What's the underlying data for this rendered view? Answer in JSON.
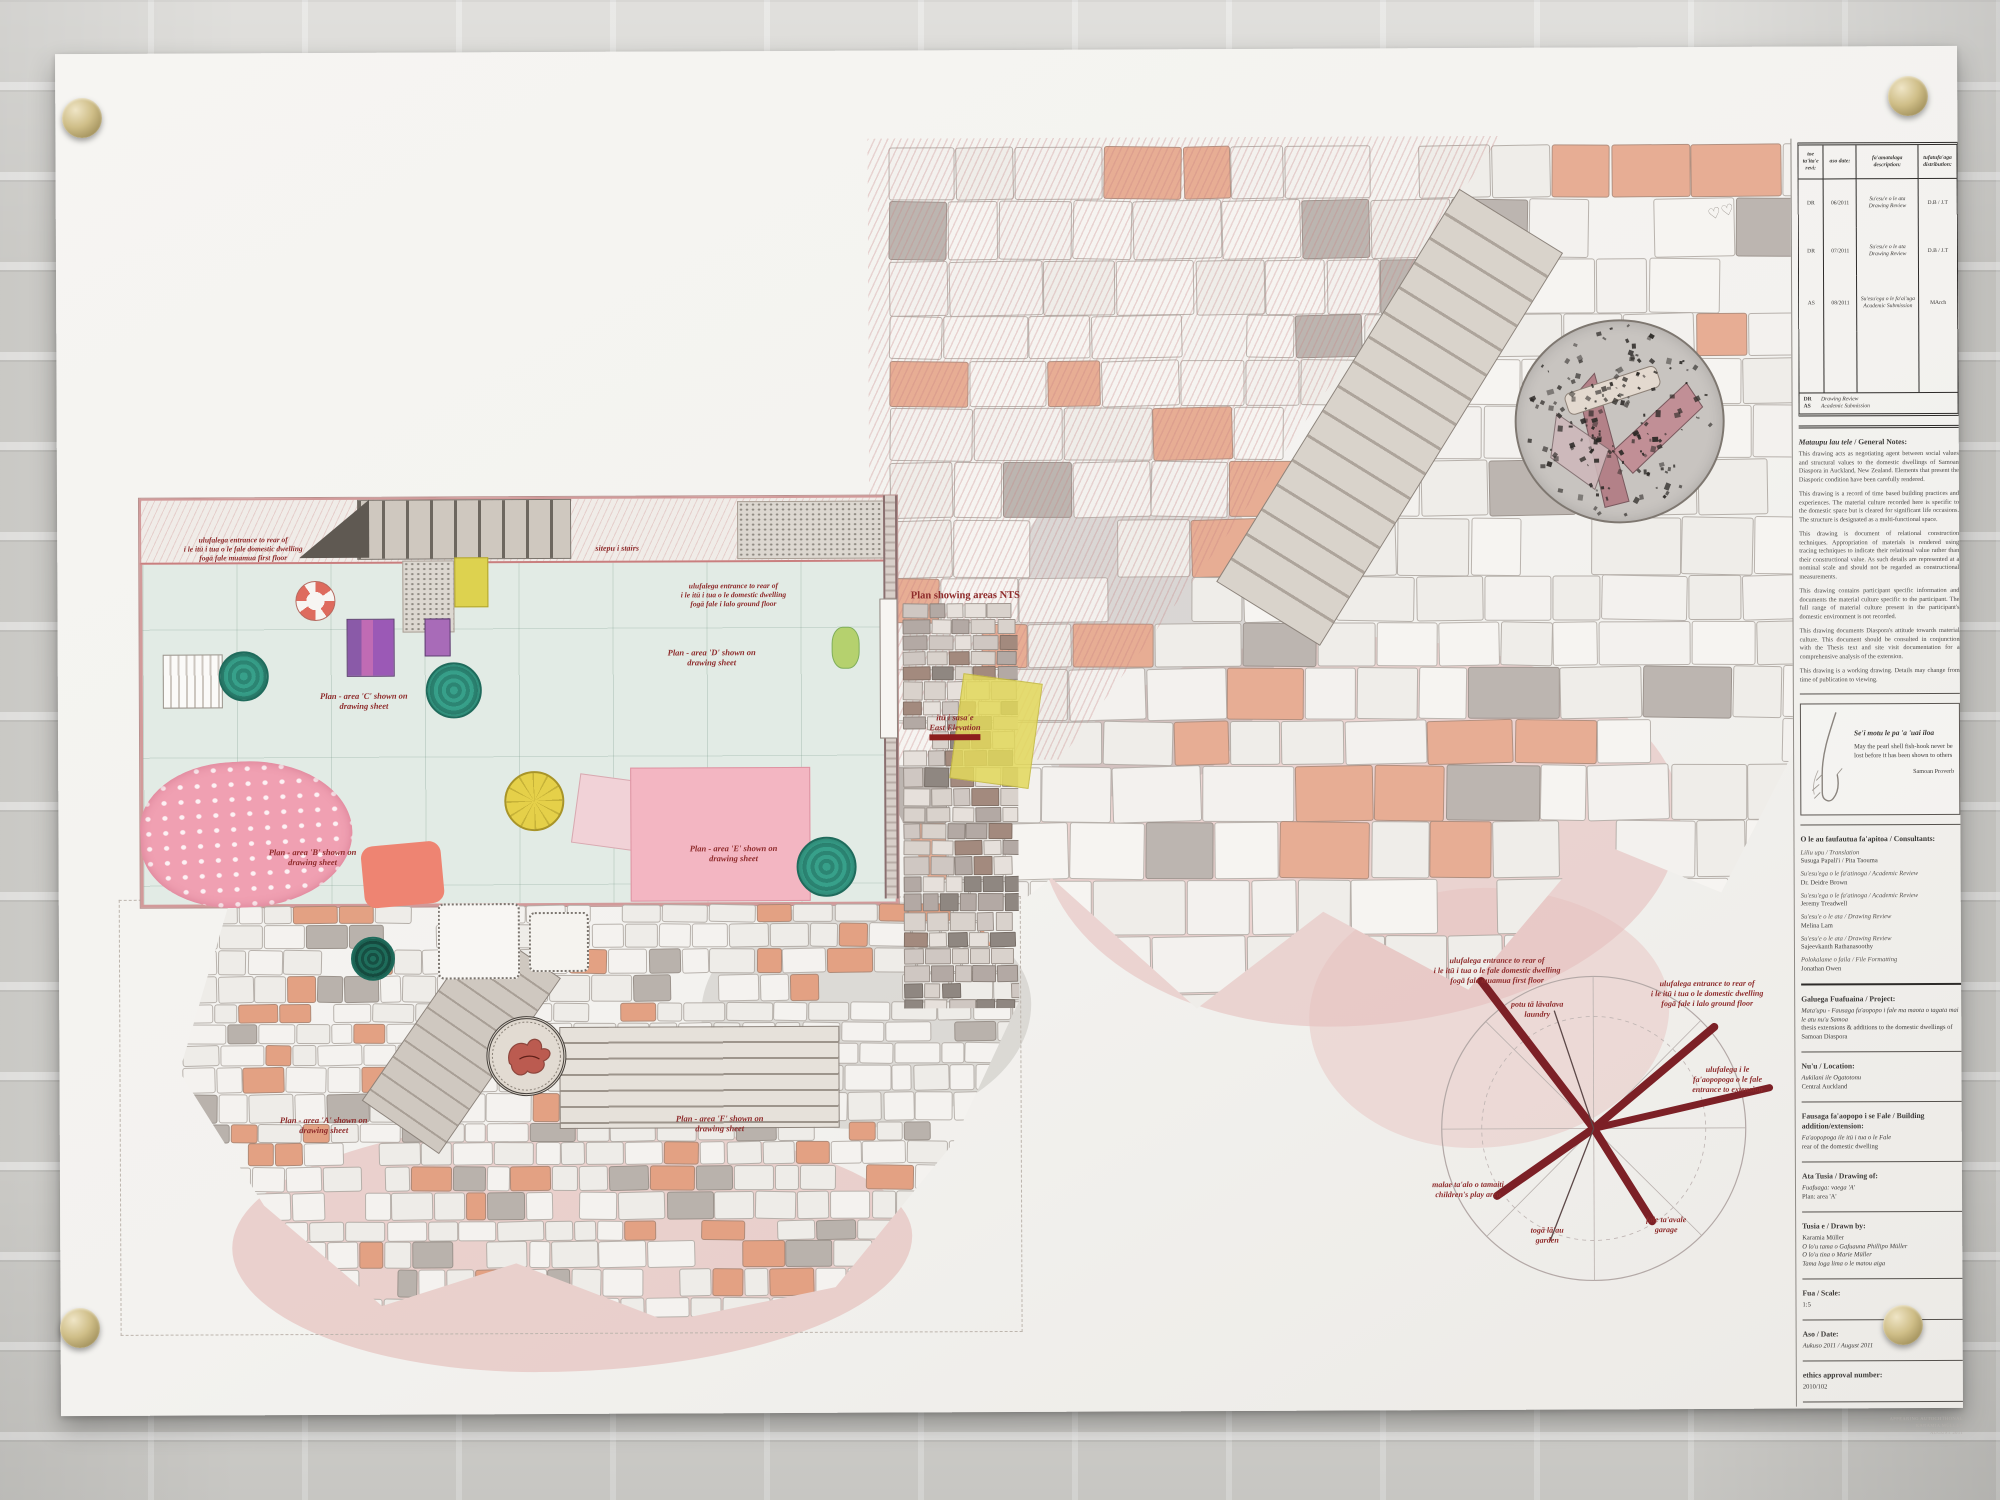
{
  "scene": {
    "accent_red": "#8e2b2b",
    "ray_color": "#7c2026",
    "magnet_color": "#cfbe88",
    "sheet_color": "#f3f2ef"
  },
  "plan_annotations": [
    {
      "id": "label-entrance-first-floor",
      "x": 186,
      "y": 482,
      "size": 7.5,
      "lines": [
        "ulufalega entrance to rear of",
        "i le itū i tua o le fale domestic dwelling",
        "fogā fale muamua first floor"
      ]
    },
    {
      "id": "label-stairs",
      "x": 560,
      "y": 492,
      "size": 8,
      "lines": [
        "sitepu i stairs"
      ]
    },
    {
      "id": "label-area-c",
      "x": 306,
      "y": 638,
      "size": 8.5,
      "lines": [
        "Plan - area 'C' shown on",
        "drawing sheet"
      ]
    },
    {
      "id": "label-entrance-ground-floor",
      "x": 676,
      "y": 530,
      "size": 7.5,
      "lines": [
        "ulufalega entrance to rear of",
        "i le itū i tua o le domestic dwelling",
        "fogā fale i lalo ground floor"
      ]
    },
    {
      "id": "label-plan-nts",
      "x": 908,
      "y": 540,
      "size": 10.5,
      "noitalic": true,
      "lines": [
        "Plan showing areas NTS"
      ]
    },
    {
      "id": "label-area-d",
      "x": 654,
      "y": 596,
      "size": 8.5,
      "lines": [
        "Plan - area 'D' shown on",
        "drawing sheet"
      ]
    },
    {
      "id": "label-east-elevation",
      "x": 897,
      "y": 662,
      "size": 8.5,
      "bar": true,
      "lines": [
        "itū i sasa'e",
        "East Elevation"
      ]
    },
    {
      "id": "label-area-b",
      "x": 254,
      "y": 794,
      "size": 8.5,
      "lines": [
        "Plan - area 'B' shown on",
        "drawing sheet"
      ]
    },
    {
      "id": "label-area-e",
      "x": 675,
      "y": 792,
      "size": 8.5,
      "lines": [
        "Plan - area 'E' shown on",
        "drawing sheet"
      ]
    },
    {
      "id": "label-area-a",
      "x": 264,
      "y": 1062,
      "size": 8.5,
      "lines": [
        "Plan - area 'A' shown on",
        "drawing sheet"
      ]
    },
    {
      "id": "label-area-f",
      "x": 660,
      "y": 1062,
      "size": 8.5,
      "lines": [
        "Plan - area 'F' shown on",
        "drawing sheet"
      ]
    }
  ],
  "compass_labels": [
    {
      "id": "compass-entrance-first-floor",
      "x": 1438,
      "y": 908,
      "lines": [
        "ulufalega entrance to rear of",
        "i le itū i tua o le fale domestic dwelling",
        "fogā fale muamua first floor"
      ]
    },
    {
      "id": "compass-laundry",
      "x": 1478,
      "y": 952,
      "lines": [
        "potu tā lāvalava",
        "laundry"
      ]
    },
    {
      "id": "compass-entrance-ground-floor",
      "x": 1648,
      "y": 932,
      "lines": [
        "ulufalega entrance to rear of",
        "i le itū i tua o le domestic dwelling",
        "fogā fale i lalo ground floor"
      ]
    },
    {
      "id": "compass-entrance-extension",
      "x": 1668,
      "y": 1018,
      "lines": [
        "ulufalega i le",
        "fa'aopopoga o le fale",
        "entrance to extension"
      ]
    },
    {
      "id": "compass-play-area",
      "x": 1408,
      "y": 1132,
      "lines": [
        "malae ta'alo o tamaiti",
        "children's play area"
      ]
    },
    {
      "id": "compass-garden",
      "x": 1487,
      "y": 1178,
      "lines": [
        "togā lā'au",
        "garden"
      ]
    },
    {
      "id": "compass-garage",
      "x": 1606,
      "y": 1168,
      "lines": [
        "fale ta'avale",
        "garage"
      ]
    }
  ],
  "revision_table": {
    "headers": [
      "toe ta'ita'e revi:",
      "aso date:",
      "fa'amatalaga description:",
      "tufatufa'aga distribution:"
    ],
    "rows": [
      {
        "rev": "DR",
        "date": "06/2011",
        "desc": "Su'esu'e o le ata Drawing Review",
        "dist": "D.B / J.T"
      },
      {
        "rev": "DR",
        "date": "07/2011",
        "desc": "Su'esu'e o le ata Drawing Review",
        "dist": "D.B / J.T"
      },
      {
        "rev": "AS",
        "date": "08/2011",
        "desc": "Su'esu'ega o le fa'ai'uga Academic Submission",
        "dist": "MArch"
      }
    ],
    "legend": [
      {
        "code": "DR",
        "meaning": "Drawing Review"
      },
      {
        "code": "AS",
        "meaning": "Academic Submission"
      }
    ]
  },
  "general_notes": {
    "heading_samoan": "Mataupu lau tele",
    "heading_english": "General Notes:",
    "paragraphs": [
      "This drawing acts as negotiating agent between social values and structural values to the domestic dwellings of Samoan Diaspora in Auckland, New Zealand. Elements that present the Diasporic condition have been carefully rendered.",
      "This drawing is a record of time based building practices and experiences. The material culture recorded here is specific to the domestic space but is cleared for significant life occasions. The structure is designated as a multi-functional space.",
      "This drawing is document of relational construction techniques. Appropriation of materials is rendered using tracing techniques to indicate their relational value rather than their constructional value. As such details are represented at a nominal scale and should not be regarded as constructional measurements.",
      "This drawing contains participant specific information and documents the material culture specific to the participant. The full range of material culture present in the participant's domestic environment is not recorded.",
      "This drawing documents Diaspora's attitude towards material culture. This document should be consulted in conjunction with the Thesis text and site visit documentation for a comprehensive analysis of the extension.",
      "This drawing is a working drawing. Details may change from time of publication to viewing."
    ]
  },
  "proverb": {
    "samoan": "Se'i motu le pa 'a 'uai iloa",
    "english": "May the pearl shell fish-hook never be lost before it has been shown to others",
    "source": "Samoan Proverb"
  },
  "consultants": {
    "heading": "O le au faufautua fa'apitoa / Consultants:",
    "entries": [
      {
        "role": "Liliu upu / Translation",
        "name": "Susuga Papali'i / Pita Taouma"
      },
      {
        "role": "Su'esu'ega o le fa'atinoga / Academic Review",
        "name": "Dr. Deidre Brown"
      },
      {
        "role": "Su'esu'ega o le fa'atinoga / Academic Review",
        "name": "Jeremy Treadwell"
      },
      {
        "role": "Su'esu'e o le ata / Drawing Review",
        "name": "Melina Lam"
      },
      {
        "role": "Su'esu'e o le ata / Drawing Review",
        "name": "Sajeevkanth Rathanasoothy"
      },
      {
        "role": "Polokalame o faila / File Formatting",
        "name": "Jonathan Owen"
      }
    ]
  },
  "info_sections": [
    {
      "heading": "Galuega Fuafuaina / Project:",
      "lines": [
        {
          "t": "Mata'upu - Fausaga fa'aopopo i fale ma maota o tagata mai le atu nu'u Samoa",
          "i": true
        },
        {
          "t": "thesis extensions & additions to the domestic dwellings of Samoan Diaspora"
        }
      ]
    },
    {
      "heading": "Nu'u / Location:",
      "lines": [
        {
          "t": "Aukilani ile Ogatotonu",
          "i": true
        },
        {
          "t": "Central Auckland"
        }
      ]
    },
    {
      "heading": "Fausaga fa'aopopo i se Fale / Building addition/extension:",
      "lines": [
        {
          "t": "Fa'aopopoga ile itū i tua o le Fale",
          "i": true
        },
        {
          "t": "rear of the domestic dwelling"
        }
      ]
    },
    {
      "heading": "Ata Tusia / Drawing of:",
      "lines": [
        {
          "t": "Fuafuaga: vaega 'A'",
          "i": true
        },
        {
          "t": "Plan: area 'A'"
        }
      ]
    },
    {
      "heading": "Tusia e / Drawn by:",
      "lines": [
        {
          "t": "Karamia Müller"
        },
        {
          "t": "O lo'u tama o Gafuauna Phillipo Müller",
          "i": true
        },
        {
          "t": "O lo'u tina o Marie Müller",
          "i": true
        },
        {
          "t": "Tama loga lima o le matou aiga",
          "i": true
        }
      ]
    },
    {
      "heading": "Fua / Scale:",
      "lines": [
        {
          "t": "1:5"
        }
      ]
    },
    {
      "heading": "Aso / Date:",
      "lines": [
        {
          "t": "Aukuso 2011 / August 2011",
          "i": true
        }
      ]
    },
    {
      "heading": "ethics approval number:",
      "lines": [
        {
          "t": "2010/102"
        }
      ]
    }
  ],
  "footer": {
    "lines": [
      "APPEARING AUTOCHTHONAL",
      "KARAMIA MÜLLER",
      "AUGUST 2011"
    ]
  }
}
